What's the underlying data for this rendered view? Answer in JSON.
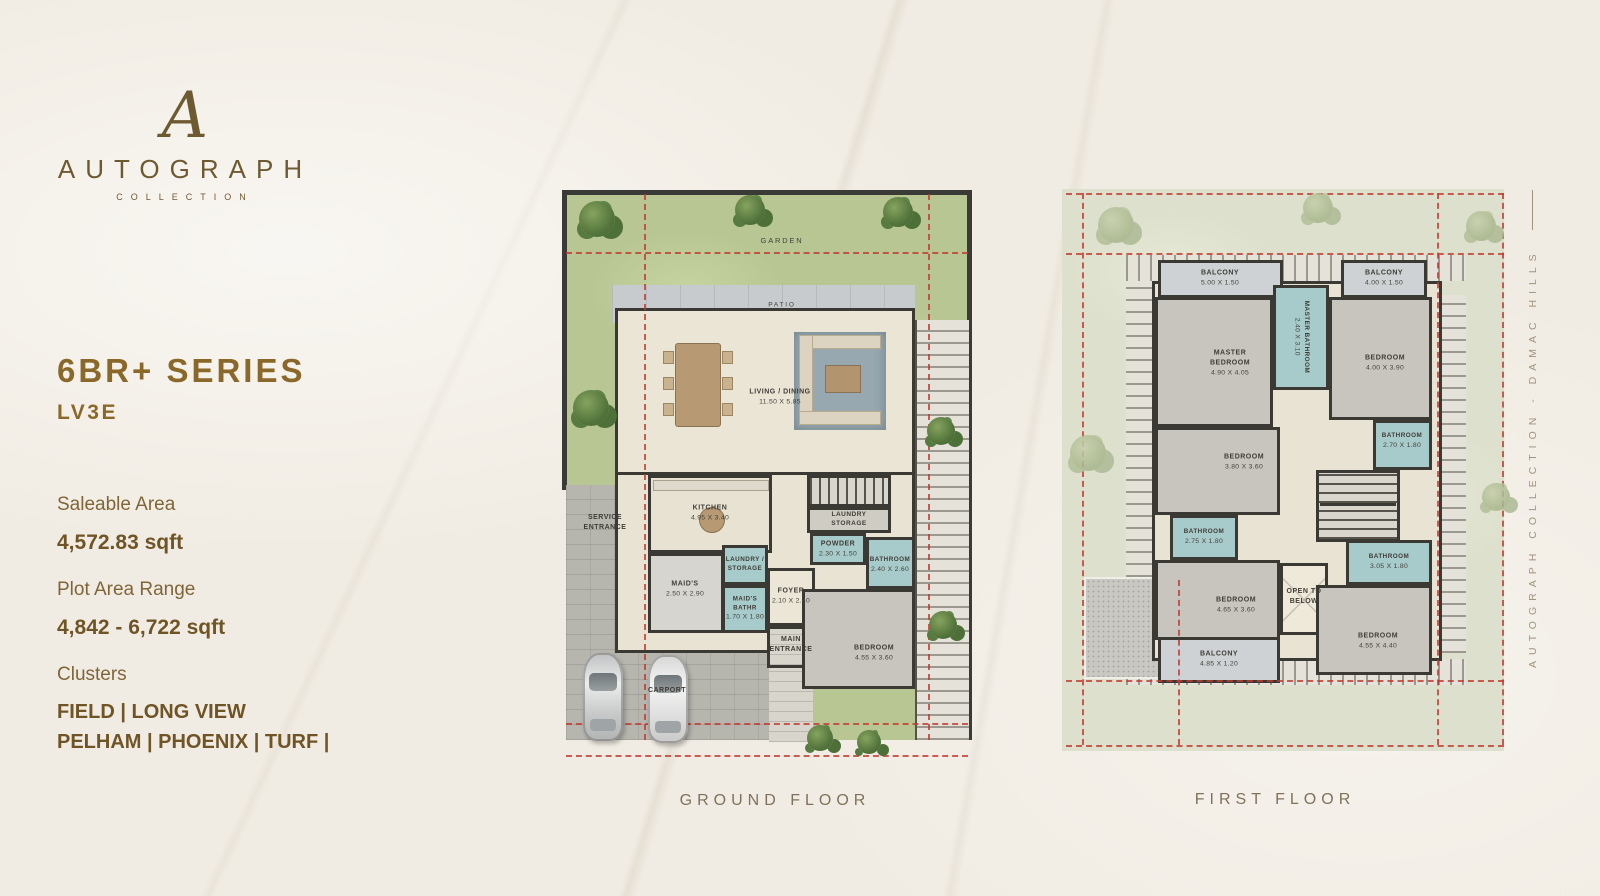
{
  "brand": {
    "monogram": "A",
    "name": "AUTOGRAPH",
    "tagline": "COLLECTION"
  },
  "series": {
    "title": "6BR+ SERIES",
    "variant": "LV3E"
  },
  "specs": {
    "saleable_label": "Saleable Area",
    "saleable_value": "4,572.83 sqft",
    "plot_label": "Plot Area Range",
    "plot_value": "4,842 - 6,722 sqft",
    "clusters_label": "Clusters",
    "clusters_line1": "FIELD | LONG VIEW",
    "clusters_line2": "PELHAM | PHOENIX | TURF |"
  },
  "side_text": "AUTOGRAPH COLLECTION - DAMAC HILLS",
  "colors": {
    "accent_brown": "#8a682a",
    "text_brown": "#7f6637",
    "boundary_red": "#c2392e",
    "bath_teal": "#a7caca",
    "wall_dark": "#3b3933",
    "garden_green": "#bcca98",
    "garden_pale": "#dfe2cf"
  },
  "floors": {
    "ground": {
      "title": "GROUND FLOOR",
      "rooms": [
        {
          "name": "GARDEN",
          "dims": ""
        },
        {
          "name": "PATIO",
          "dims": ""
        },
        {
          "name": "LIVING / DINING",
          "dims": "11.50 X 5.85"
        },
        {
          "name": "KITCHEN",
          "dims": "4.95 X 3.40"
        },
        {
          "name": "SERVICE ENTRANCE",
          "dims": ""
        },
        {
          "name": "LAUNDRY / STORAGE",
          "dims": ""
        },
        {
          "name": "MAID'S",
          "dims": "2.50 X 2.90"
        },
        {
          "name": "MAID'S BATHR",
          "dims": "1.70 X 1.80"
        },
        {
          "name": "FOYER",
          "dims": "2.10 X 2.40"
        },
        {
          "name": "MAIN ENTRANCE",
          "dims": ""
        },
        {
          "name": "LAUNDRY STORAGE",
          "dims": ""
        },
        {
          "name": "POWDER",
          "dims": "2.30 X 1.50"
        },
        {
          "name": "BATHROOM",
          "dims": "2.40 X 2.60"
        },
        {
          "name": "BEDROOM",
          "dims": "4.55 X 3.60"
        },
        {
          "name": "CARPORT",
          "dims": ""
        }
      ]
    },
    "first": {
      "title": "FIRST FLOOR",
      "rooms": [
        {
          "name": "BALCONY",
          "dims": "5.00 X 1.50"
        },
        {
          "name": "BALCONY",
          "dims": "4.00 X 1.50"
        },
        {
          "name": "MASTER BEDROOM",
          "dims": "4.90 X 4.05"
        },
        {
          "name": "MASTER BATHROOM",
          "dims": "2.40 X 3.10"
        },
        {
          "name": "BEDROOM",
          "dims": "4.00 X 3.90"
        },
        {
          "name": "BATHROOM",
          "dims": "2.70 X 1.80"
        },
        {
          "name": "BEDROOM",
          "dims": "3.80 X 3.60"
        },
        {
          "name": "BATHROOM",
          "dims": "2.75 X 1.80"
        },
        {
          "name": "BEDROOM",
          "dims": "4.65 X 3.60"
        },
        {
          "name": "BALCONY",
          "dims": "4.85 X 1.20"
        },
        {
          "name": "OPEN TO BELOW",
          "dims": ""
        },
        {
          "name": "BATHROOM",
          "dims": "3.05 X 1.80"
        },
        {
          "name": "BEDROOM",
          "dims": "4.55 X 4.40"
        }
      ]
    }
  }
}
